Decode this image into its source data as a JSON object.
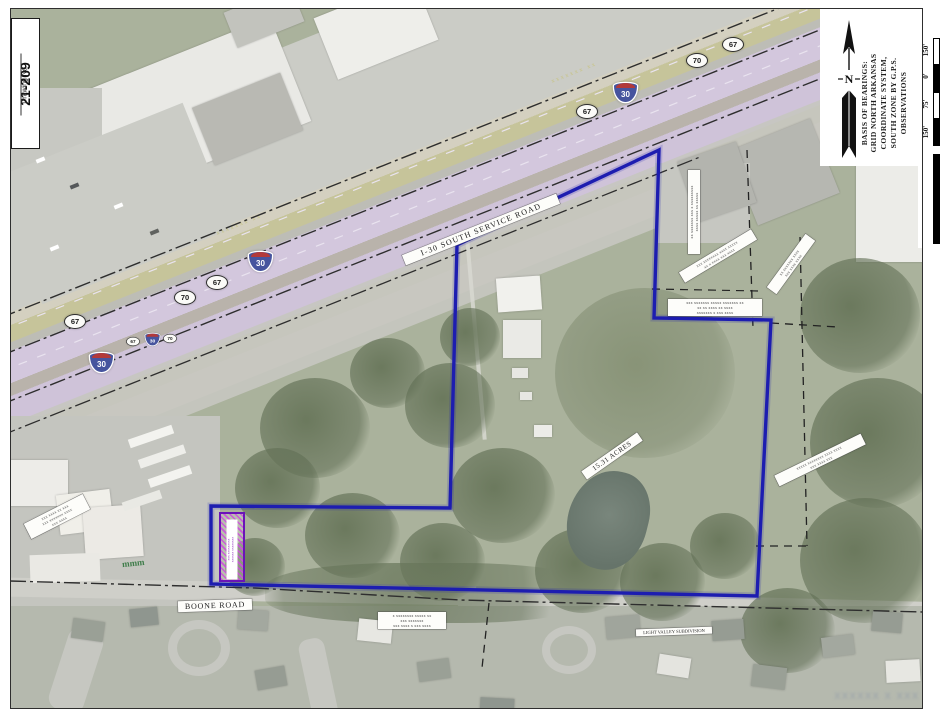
{
  "title_block": {
    "number": "21-209",
    "caption": "Drawing No."
  },
  "north": {
    "lines": [
      "BASIS OF BEARINGS:",
      "GRID NORTH ARKANSAS",
      "COORDINATE SYSTEM,",
      "SOUTH ZONE BY G.P.S.",
      "OBSERVATIONS"
    ],
    "n_letter": "N"
  },
  "scale": {
    "labels": [
      "150'",
      "0'",
      "75'",
      "150'"
    ]
  },
  "roads": {
    "service_road": "I-30 SOUTH SERVICE ROAD",
    "boone_road": "BOONE ROAD"
  },
  "shields": {
    "i30": "30",
    "us67": "67",
    "us70": "70"
  },
  "site": {
    "acreage": "15.31 ACRES",
    "subdivision": "LIGHT VALLEY SUBDIVISION"
  },
  "micro": {
    "t1": "xx xxxxxxx xxx x xxxxxxxxx\nxxxx xxxxx xx xxxxx",
    "t2": "xxx xxxxxxxx xxxx xxxxx\nxx x xxxx xxx xxxx",
    "t3": "xx xxxxxxx xxxx\nxxx xxxx xxxx",
    "t4": "xxx xxxxxxx xxxxx xxxxxxx xx\nxx xx xxxx xx xxxx\nxxxxxxx x xxx xxxx",
    "t5": "xxxxx xxxxxxxx xxxx xxxx\nxxx xxxx xxx",
    "t6": "xxx xxxx xx xxx\nxxx xxxxxxx xxxx\nxxx xxxx",
    "t7": "x xxxxxxxx xxxxx xx\nxxx xxxxxxx\nxxx xxxx x xxx xxxx",
    "easement": "xxx xxxxxxxxx\nxxxxxx xxxxxxxx",
    "ghost1": "xxxxxxx xx",
    "ghost2": "xxxxxxx xx"
  },
  "watermark": "xxxxxx x xxx",
  "colors": {
    "boundary_blue": "#1d1db0",
    "easement_purple": "#6a14b8",
    "easement_hatch": "#ce52de",
    "highway_tint": "#d3c7dd",
    "median_olive": "#c6c49a",
    "interstate_shield_blue": "#46549e",
    "interstate_shield_red": "#b23a3a",
    "line_black": "#2e2e2e"
  }
}
